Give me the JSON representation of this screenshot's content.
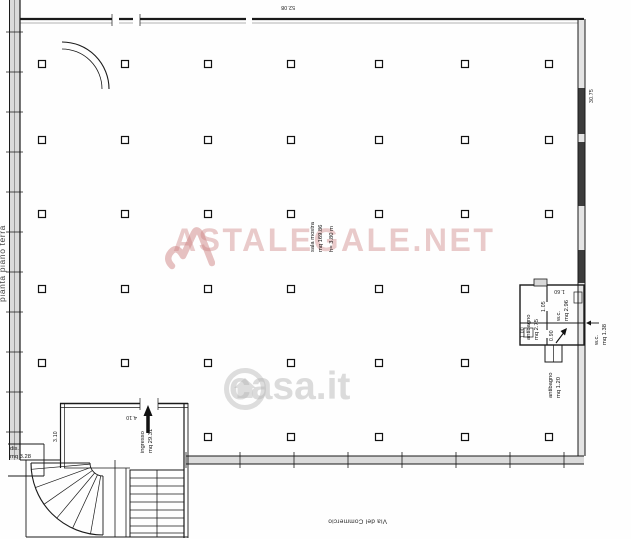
{
  "title": {
    "side_label": "pianta piano terra"
  },
  "street": {
    "label": "Via del Commercio"
  },
  "watermarks": {
    "astalegale": {
      "text": "ASTALEGALE.NET",
      "color": "#cd8383"
    },
    "casait": {
      "text": "casa.it",
      "color": "#b9b9b9"
    }
  },
  "rooms": {
    "sala": {
      "name": "sala mostra",
      "area": "mq 169.86",
      "height": "h= 3.80 m"
    },
    "ingresso": {
      "name": "ingresso",
      "area": "mq 29.31"
    },
    "dis": {
      "name": "dis.",
      "area": "mq 3.28"
    },
    "antibagno_top": {
      "name": "antibagno",
      "area": "mq 2.75"
    },
    "wc_top": {
      "name": "w.c.",
      "area": "mq 2.96"
    },
    "wc_right": {
      "name": "w.c.",
      "area": "mq 1.38"
    },
    "antibagno_bottom": {
      "name": "antibagno",
      "area": "mq 1.20"
    }
  },
  "dimensions": {
    "building_width": "52.08",
    "building_depth": "30.75",
    "entrance_width": "4.10",
    "entrance_depth": "3.10",
    "wc_width": "1.60",
    "dim_a": "1.05",
    "dim_b": "1.00",
    "dim_c": "0.90"
  }
}
